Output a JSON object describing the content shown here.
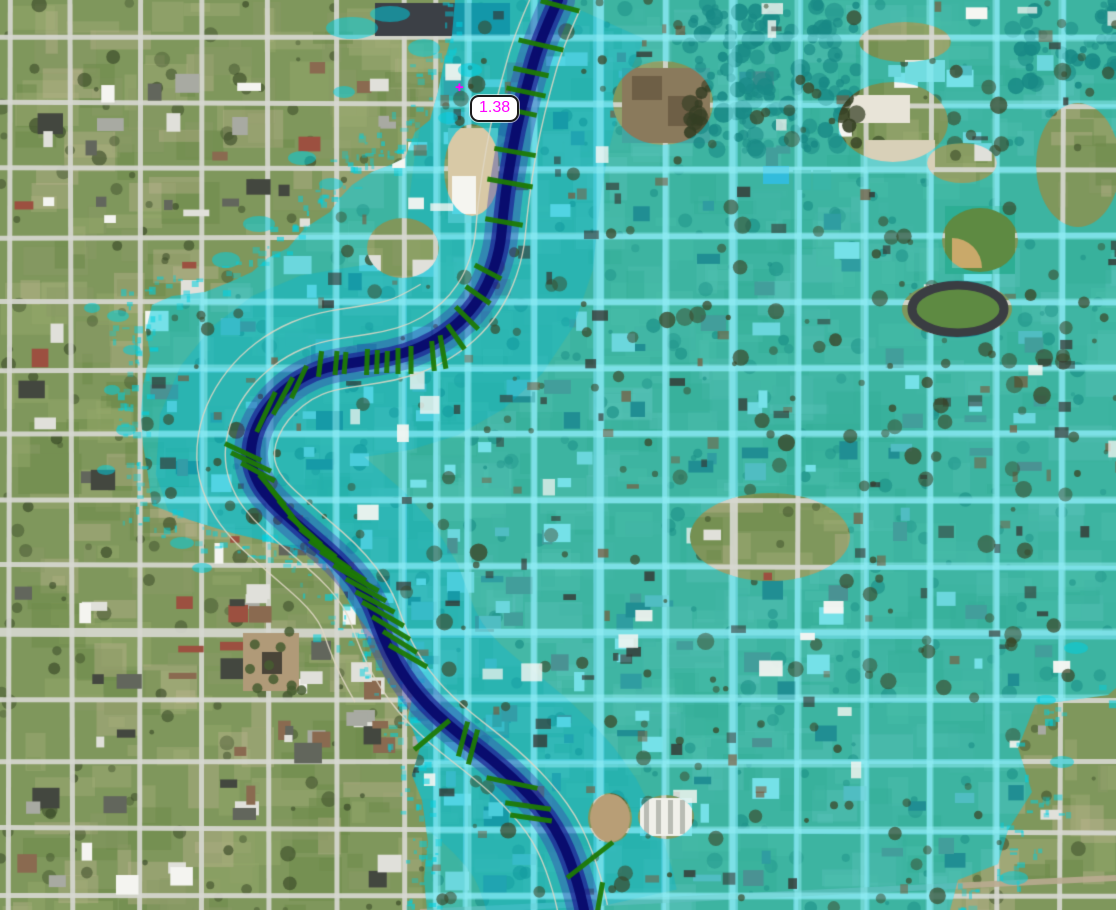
{
  "meta": {
    "view_type": "flood-inundation-map",
    "description": "Aerial imagery basemap with flood depth overlay, river channel, bank lines and cross-section cut lines",
    "width": 1116,
    "height": 910
  },
  "labels": {
    "river_station": {
      "text": "1.38",
      "x": 470,
      "y": 95,
      "text_color": "#ff00ff",
      "bg_color": "#ffffff",
      "border_color": "#1a1a1a"
    },
    "station_marker": {
      "glyph": "+",
      "x": 455,
      "y": 83,
      "color": "#ff00ff"
    }
  },
  "legend_colors": {
    "flood_overlay": "rgba(0,208,224,0.52)",
    "flood_corridor": "rgba(0,183,214,0.30)",
    "flooded_street": "rgba(150,240,247,0.50)",
    "channel_halo": "rgba(55,64,174,0.40)",
    "channel_mid": "rgba(28,35,148,0.72)",
    "channel_core": "rgba(8,9,108,0.95)",
    "cross_section": "#1d7a05",
    "bank_line": "rgba(224,216,198,0.85)"
  },
  "river_path": [
    [
      558,
      0
    ],
    [
      540,
      40
    ],
    [
      527,
      85
    ],
    [
      516,
      130
    ],
    [
      508,
      175
    ],
    [
      503,
      215
    ],
    [
      500,
      250
    ],
    [
      488,
      285
    ],
    [
      470,
      312
    ],
    [
      448,
      332
    ],
    [
      420,
      348
    ],
    [
      390,
      357
    ],
    [
      358,
      362
    ],
    [
      326,
      367
    ],
    [
      300,
      378
    ],
    [
      278,
      395
    ],
    [
      262,
      415
    ],
    [
      252,
      438
    ],
    [
      250,
      462
    ],
    [
      258,
      484
    ],
    [
      272,
      502
    ],
    [
      292,
      520
    ],
    [
      315,
      540
    ],
    [
      338,
      560
    ],
    [
      358,
      582
    ],
    [
      372,
      605
    ],
    [
      380,
      628
    ],
    [
      390,
      652
    ],
    [
      403,
      675
    ],
    [
      418,
      695
    ],
    [
      436,
      714
    ],
    [
      458,
      733
    ],
    [
      480,
      750
    ],
    [
      502,
      768
    ],
    [
      522,
      787
    ],
    [
      540,
      807
    ],
    [
      555,
      828
    ],
    [
      566,
      850
    ],
    [
      574,
      872
    ],
    [
      580,
      892
    ],
    [
      584,
      910
    ]
  ],
  "cross_sections": [
    [
      560,
      6,
      15,
      40
    ],
    [
      541,
      45,
      13,
      46
    ],
    [
      531,
      72,
      12,
      36
    ],
    [
      526,
      92,
      12,
      40
    ],
    [
      521,
      112,
      12,
      32
    ],
    [
      515,
      152,
      10,
      42
    ],
    [
      510,
      183,
      10,
      46
    ],
    [
      504,
      222,
      10,
      38
    ],
    [
      488,
      272,
      28,
      30
    ],
    [
      478,
      295,
      35,
      30
    ],
    [
      467,
      318,
      45,
      32
    ],
    [
      456,
      337,
      55,
      30
    ],
    [
      443,
      352,
      80,
      34
    ],
    [
      433,
      356,
      85,
      30
    ],
    [
      411,
      360,
      90,
      28
    ],
    [
      398,
      361,
      90,
      26
    ],
    [
      387,
      362,
      92,
      22
    ],
    [
      377,
      362,
      92,
      24
    ],
    [
      367,
      362,
      92,
      26
    ],
    [
      345,
      363,
      95,
      22
    ],
    [
      336,
      363,
      95,
      24
    ],
    [
      320,
      364,
      97,
      26
    ],
    [
      299,
      382,
      115,
      36
    ],
    [
      283,
      396,
      118,
      42
    ],
    [
      266,
      412,
      115,
      44
    ],
    [
      243,
      452,
      25,
      40
    ],
    [
      251,
      462,
      25,
      44
    ],
    [
      258,
      472,
      28,
      38
    ],
    [
      272,
      490,
      50,
      40
    ],
    [
      281,
      502,
      52,
      38
    ],
    [
      290,
      514,
      50,
      36
    ],
    [
      305,
      530,
      42,
      44
    ],
    [
      318,
      543,
      38,
      46
    ],
    [
      330,
      555,
      35,
      50
    ],
    [
      343,
      566,
      33,
      54
    ],
    [
      356,
      578,
      30,
      52
    ],
    [
      366,
      590,
      29,
      46
    ],
    [
      375,
      602,
      28,
      44
    ],
    [
      383,
      614,
      30,
      48
    ],
    [
      391,
      628,
      31,
      44
    ],
    [
      400,
      642,
      32,
      40
    ],
    [
      408,
      656,
      30,
      44
    ],
    [
      432,
      735,
      140,
      46
    ],
    [
      463,
      739,
      105,
      36
    ],
    [
      473,
      747,
      105,
      36
    ],
    [
      512,
      783,
      12,
      52
    ],
    [
      528,
      806,
      8,
      46
    ],
    [
      531,
      818,
      8,
      42
    ],
    [
      590,
      860,
      142,
      58
    ],
    [
      600,
      897,
      100,
      30
    ]
  ],
  "flood_boundary": [
    [
      455,
      0
    ],
    [
      452,
      35
    ],
    [
      444,
      62
    ],
    [
      438,
      92
    ],
    [
      430,
      120
    ],
    [
      415,
      132
    ],
    [
      405,
      158
    ],
    [
      390,
      165
    ],
    [
      372,
      172
    ],
    [
      352,
      185
    ],
    [
      340,
      198
    ],
    [
      330,
      212
    ],
    [
      305,
      228
    ],
    [
      288,
      248
    ],
    [
      268,
      258
    ],
    [
      252,
      272
    ],
    [
      230,
      282
    ],
    [
      205,
      292
    ],
    [
      172,
      296
    ],
    [
      152,
      305
    ],
    [
      146,
      330
    ],
    [
      150,
      355
    ],
    [
      143,
      385
    ],
    [
      141,
      415
    ],
    [
      143,
      445
    ],
    [
      148,
      475
    ],
    [
      152,
      505
    ],
    [
      190,
      520
    ],
    [
      232,
      533
    ],
    [
      270,
      542
    ],
    [
      302,
      550
    ],
    [
      325,
      562
    ],
    [
      340,
      585
    ],
    [
      352,
      608
    ],
    [
      368,
      630
    ],
    [
      384,
      648
    ],
    [
      398,
      668
    ],
    [
      415,
      685
    ],
    [
      408,
      718
    ],
    [
      420,
      748
    ],
    [
      412,
      775
    ],
    [
      422,
      800
    ],
    [
      428,
      842
    ],
    [
      424,
      878
    ],
    [
      427,
      910
    ],
    [
      950,
      910
    ],
    [
      958,
      880
    ],
    [
      998,
      864
    ],
    [
      1008,
      830
    ],
    [
      1032,
      792
    ],
    [
      1018,
      748
    ],
    [
      1035,
      705
    ],
    [
      1108,
      695
    ],
    [
      1116,
      688
    ],
    [
      1116,
      0
    ]
  ],
  "flood_holes": [
    [
      905,
      42,
      46,
      20
    ],
    [
      893,
      122,
      55,
      40
    ],
    [
      962,
      163,
      35,
      20
    ],
    [
      980,
      240,
      38,
      32
    ],
    [
      957,
      309,
      55,
      28
    ],
    [
      1078,
      165,
      42,
      62
    ],
    [
      663,
      103,
      50,
      42
    ],
    [
      770,
      537,
      80,
      44
    ],
    [
      610,
      818,
      22,
      25
    ],
    [
      666,
      817,
      28,
      22
    ],
    [
      403,
      248,
      36,
      30
    ],
    [
      472,
      170,
      28,
      46
    ]
  ],
  "flood_patches": [
    [
      352,
      28,
      26,
      11
    ],
    [
      390,
      14,
      20,
      8
    ],
    [
      424,
      48,
      16,
      9
    ],
    [
      344,
      92,
      11,
      6
    ],
    [
      302,
      158,
      14,
      7
    ],
    [
      331,
      184,
      12,
      6
    ],
    [
      259,
      224,
      16,
      8
    ],
    [
      226,
      260,
      14,
      8
    ],
    [
      118,
      316,
      11,
      6
    ],
    [
      92,
      308,
      8,
      5
    ],
    [
      132,
      350,
      9,
      5
    ],
    [
      112,
      390,
      8,
      5
    ],
    [
      126,
      430,
      10,
      6
    ],
    [
      106,
      470,
      9,
      5
    ],
    [
      182,
      543,
      12,
      6
    ],
    [
      202,
      568,
      10,
      5
    ],
    [
      448,
      118,
      10,
      6
    ],
    [
      470,
      70,
      12,
      7
    ],
    [
      1046,
      700,
      10,
      5
    ],
    [
      1076,
      648,
      12,
      6
    ],
    [
      1014,
      878,
      14,
      7
    ],
    [
      1062,
      762,
      12,
      6
    ]
  ]
}
